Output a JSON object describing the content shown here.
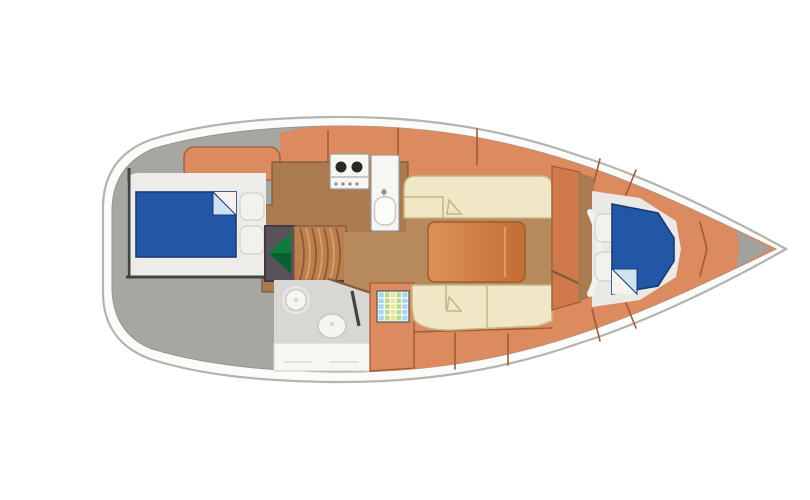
{
  "meta": {
    "description": "Top-down interior floor plan diagram of a sailing yacht, bow pointing right, no visible text in image"
  },
  "semantics": {
    "aft_cabin": "aft double cabin with berth and pillows",
    "companionway": "companionway with hatch arrow and curved steps",
    "galley": "galley with two-burner stove and sink",
    "head": "head wet-room with washbasin, toilet, door and counter",
    "salon": "salon with two facing settees and centre table",
    "chart_table": "mosaic-top chart table",
    "v_berth": "forward V-berth cabin with berth and pillows",
    "side_decks": "salmon coachroof and side panels",
    "deck": "grey deck at stern and bow tip"
  },
  "colors": {
    "page_bg": "#ffffff",
    "hull_white": "#fbfbf9",
    "hull_stroke": "#b3b3b0",
    "deck_gray": "#a8a6a3",
    "deck_stroke": "#96948f",
    "salmon": "#dc8a5f",
    "salmon_dark": "#d07a4c",
    "salmon_seam": "#a25c34",
    "wood": "#aa7a50",
    "wood_seam": "#7e5a3a",
    "floor_brown": "#b78a5d",
    "cabin_floor": "#edece8",
    "berth_blue": "#2356a5",
    "berth_stroke": "#173c74",
    "fold_light": "#cfe2f4",
    "white_fold": "#f4f3ef",
    "pillow": "#f2f1ec",
    "pillow_stroke": "#d6d5d0",
    "dark_trim": "#454340",
    "comp_box": "#59525b",
    "comp_stroke": "#403b44",
    "green": "#0f7c3e",
    "green_dark": "#09612f",
    "steps": "#bd7f4d",
    "steps_line_dark": "#8a5a33",
    "steps_line_light": "#d9a16d",
    "appliance_white": "#f6f6f3",
    "appliance_stroke": "#9b9b96",
    "burner": "#292927",
    "knob": "#8b8b87",
    "head_floor": "#d8d7d3",
    "fixture": "#f6f5f1",
    "fixture_stroke": "#c9c8c3",
    "fixture_halo": "#e7e6e2",
    "counter_stroke": "#d5d4cf",
    "grid_blue": "#a9d3ee",
    "grid_green": "#b8da8e",
    "grid_yellow": "#eee294",
    "grid_stroke": "#63635f",
    "table_light": "#dd9257",
    "table_dark": "#c26d33",
    "table_stroke": "#a05c2c",
    "table_sheen": "#e09c66",
    "settee": "#f0e7c7",
    "settee_stroke": "#c6b586",
    "vfloor": "#eae9e5",
    "door_white": "#f2f1ed",
    "tip_gray": "#a3a19e"
  }
}
